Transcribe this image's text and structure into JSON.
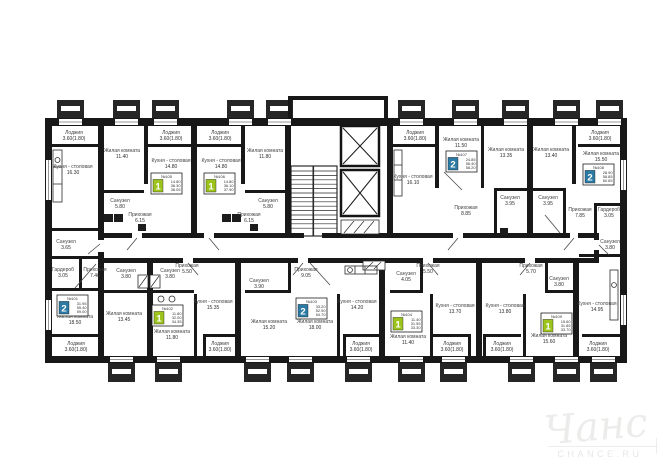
{
  "colors": {
    "wall": "#181818",
    "badge_green": "#9dc41d",
    "badge_teal": "#2d7ba4",
    "label": "#3f3f3f",
    "watermark": "#ebebeb"
  },
  "watermark": {
    "script": "Чанс",
    "caption": "CHANCE.RU"
  },
  "badges": [
    {
      "no": "№105",
      "kind": "1",
      "v1": "14.80",
      "v2": "36.30",
      "v3": "38.05",
      "color": "#9dc41d"
    },
    {
      "no": "№106",
      "kind": "1",
      "v1": "14.80",
      "v2": "36.10",
      "v3": "37.90",
      "color": "#9dc41d"
    },
    {
      "no": "№107",
      "kind": "2",
      "v1": "24.85",
      "v2": "56.40",
      "v3": "58.20",
      "color": "#2d7ba4"
    },
    {
      "no": "№108",
      "kind": "2",
      "v1": "28.90",
      "v2": "58.85",
      "v3": "60.65",
      "color": "#2d7ba4"
    },
    {
      "no": "№101",
      "kind": "2",
      "v1": "31.95",
      "v2": "55.40",
      "v3": "59.00",
      "color": "#2d7ba4"
    },
    {
      "no": "№102",
      "kind": "1",
      "v1": "11.80",
      "v2": "32.00",
      "v3": "34.35",
      "color": "#9dc41d"
    },
    {
      "no": "№103",
      "kind": "2",
      "v1": "33.20",
      "v2": "52.90",
      "v3": "54.70",
      "color": "#2d7ba4"
    },
    {
      "no": "№104",
      "kind": "1",
      "v1": "11.40",
      "v2": "31.55",
      "v3": "33.30",
      "color": "#9dc41d"
    },
    {
      "no": "№109",
      "kind": "1",
      "v1": "15.60",
      "v2": "31.85",
      "v3": "33.70",
      "color": "#9dc41d"
    }
  ],
  "rooms": [
    {
      "name": "Лоджия",
      "area": "3.60(1.80)"
    },
    {
      "name": "Кухня - столовая",
      "area": "16.30"
    },
    {
      "name": "Жилая комната",
      "area": "11.40"
    },
    {
      "name": "Лоджия",
      "area": "3.60(1.80)"
    },
    {
      "name": "Кухня - столовая",
      "area": "14.80"
    },
    {
      "name": "Санузел",
      "area": "5.80"
    },
    {
      "name": "Прихожая",
      "area": "6.15"
    },
    {
      "name": "Лоджия",
      "area": "3.60(1.80)"
    },
    {
      "name": "Кухня - столовая",
      "area": "14.80"
    },
    {
      "name": "Жилая комната",
      "area": "11.80"
    },
    {
      "name": "Санузел",
      "area": "5.80"
    },
    {
      "name": "Прихожая",
      "area": "6.15"
    },
    {
      "name": "Лоджия",
      "area": "3.60(1.80)"
    },
    {
      "name": "Кухня - столовая",
      "area": "16.10"
    },
    {
      "name": "Жилая комната",
      "area": "11.50"
    },
    {
      "name": "Жилая комната",
      "area": "13.35"
    },
    {
      "name": "Прихожая",
      "area": "8.85"
    },
    {
      "name": "Санузел",
      "area": "3.95"
    },
    {
      "name": "Жилая комната",
      "area": "13.40"
    },
    {
      "name": "Санузел",
      "area": "3.95"
    },
    {
      "name": "Жилая комната",
      "area": "15.50"
    },
    {
      "name": "Лоджия",
      "area": "3.60(1.80)"
    },
    {
      "name": "Прихожая",
      "area": "7.85"
    },
    {
      "name": "Гардероб",
      "area": "3.05"
    },
    {
      "name": "Санузел",
      "area": "3.80"
    },
    {
      "name": "Кухня - столовая",
      "area": "14.95"
    },
    {
      "name": "Лоджия",
      "area": "3.60(1.80)"
    },
    {
      "name": "Санузел",
      "area": "3.65"
    },
    {
      "name": "Гардероб",
      "area": "3.05"
    },
    {
      "name": "Прихожая",
      "area": "7.40"
    },
    {
      "name": "Жилая комната",
      "area": "18.50"
    },
    {
      "name": "Лоджия",
      "area": "3.60(1.80)"
    },
    {
      "name": "Жилая комната",
      "area": "13.45"
    },
    {
      "name": "Санузел",
      "area": "3.80"
    },
    {
      "name": "Санузел",
      "area": "3.80"
    },
    {
      "name": "Прихожая",
      "area": "5.50"
    },
    {
      "name": "Жилая комната",
      "area": "11.80"
    },
    {
      "name": "Кухня - столовая",
      "area": "15.35"
    },
    {
      "name": "Лоджия",
      "area": "3.60(1.80)"
    },
    {
      "name": "Санузел",
      "area": "3.90"
    },
    {
      "name": "Прихожая",
      "area": "9.05"
    },
    {
      "name": "Жилая комната",
      "area": "15.20"
    },
    {
      "name": "Жилая комната",
      "area": "18.00"
    },
    {
      "name": "Кухня - столовая",
      "area": "14.20"
    },
    {
      "name": "Лоджия",
      "area": "3.60(1.80)"
    },
    {
      "name": "Санузел",
      "area": "4.05"
    },
    {
      "name": "Прихожая",
      "area": "5.50"
    },
    {
      "name": "Жилая комната",
      "area": "11.40"
    },
    {
      "name": "Кухня - столовая",
      "area": "13.70"
    },
    {
      "name": "Лоджия",
      "area": "3.60(1.80)"
    },
    {
      "name": "Кухня - столовая",
      "area": "13.80"
    },
    {
      "name": "Прихожая",
      "area": "5.70"
    },
    {
      "name": "Санузел",
      "area": "3.80"
    },
    {
      "name": "Жилая комната",
      "area": "15.60"
    },
    {
      "name": "Лоджия",
      "area": "3.60(1.80)"
    }
  ]
}
